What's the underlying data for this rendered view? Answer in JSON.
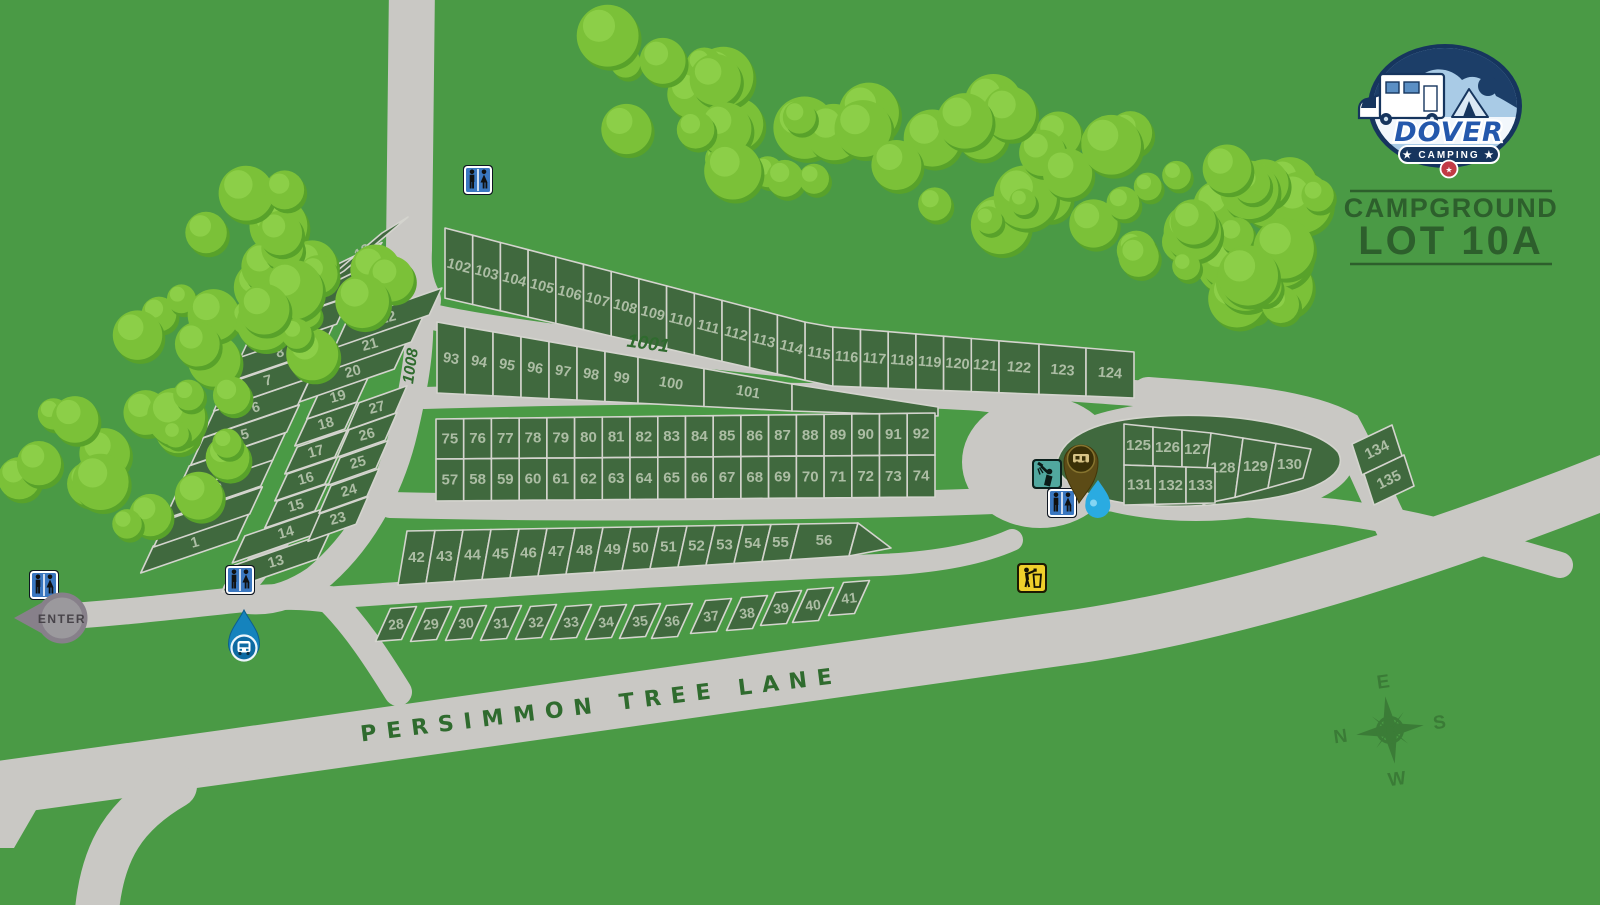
{
  "brand": {
    "logo_text": "DOVER",
    "logo_subtitle": "★ CAMPING ★",
    "title_line1": "CAMPGROUND",
    "title_line2": "LOT 10A"
  },
  "road_labels": {
    "main_road": "PERSIMMON TREE LANE",
    "loop_road": "1001",
    "spur_road": "1008"
  },
  "entrance": {
    "label": "ENTER"
  },
  "compass": {
    "north": "N",
    "east": "E",
    "south": "S",
    "west": "W"
  },
  "site_rows": {
    "west_outer": [
      1,
      2,
      3,
      4,
      5,
      6,
      7,
      8,
      9,
      10,
      11,
      12
    ],
    "west_inner": [
      13,
      14,
      15,
      16,
      17,
      18,
      19,
      20,
      21,
      22
    ],
    "west_court": [
      23,
      24,
      25,
      26,
      27
    ],
    "row_28_41": [
      28,
      29,
      30,
      31,
      32,
      33,
      34,
      35,
      36,
      37,
      38,
      39,
      40,
      41
    ],
    "row_42_56": [
      42,
      43,
      44,
      45,
      46,
      47,
      48,
      49,
      50,
      51,
      52,
      53,
      54,
      55,
      56
    ],
    "row_57_74": [
      57,
      58,
      59,
      60,
      61,
      62,
      63,
      64,
      65,
      66,
      67,
      68,
      69,
      70,
      71,
      72,
      73,
      74
    ],
    "row_75_92": [
      75,
      76,
      77,
      78,
      79,
      80,
      81,
      82,
      83,
      84,
      85,
      86,
      87,
      88,
      89,
      90,
      91,
      92
    ],
    "row_93_101": [
      93,
      94,
      95,
      96,
      97,
      98,
      99,
      100,
      101
    ],
    "row_102_124": [
      102,
      103,
      104,
      105,
      106,
      107,
      108,
      109,
      110,
      111,
      112,
      113,
      114,
      115,
      116,
      117,
      118,
      119,
      120,
      121,
      122,
      123,
      124
    ],
    "island_upper": [
      125,
      126,
      127,
      128,
      129,
      130
    ],
    "island_lower": [
      131,
      132,
      133
    ],
    "east_pair": [
      134,
      135
    ]
  },
  "facilities": [
    {
      "id": "restroom-north",
      "type": "restroom-icon"
    },
    {
      "id": "restroom-west",
      "type": "restroom-icon"
    },
    {
      "id": "restroom-central",
      "type": "restroom-icon"
    },
    {
      "id": "shower-station",
      "type": "shower-icon"
    },
    {
      "id": "restroom-east",
      "type": "restroom-icon"
    },
    {
      "id": "rv-service-pin",
      "type": "rv-pin-icon"
    },
    {
      "id": "water-point",
      "type": "water-drop-icon"
    },
    {
      "id": "trash-station",
      "type": "trash-icon"
    },
    {
      "id": "rv-water-fill",
      "type": "water-fill-icon"
    }
  ],
  "palette": {
    "grass": "#4a9a45",
    "road": "#c9c8c4",
    "site_fill": "#40693e",
    "site_border": "#d4d4ce",
    "site_number": "#acbda4",
    "map_text_green": "#2f6b2e",
    "title_green": "#2d5f2c",
    "tree_base": "#7bc138",
    "tree_shadow": "#58a22a",
    "tree_light": "#8ed04a",
    "restroom_blue": "#3a77c0",
    "shower_teal": "#51a89f",
    "trash_yellow": "#efd02b",
    "pin_brown": "#5c4b16",
    "pin_inner": "#3a3007",
    "water_blue": "#2aabe1",
    "enter_gray": "#9b999d",
    "enter_ring": "#87808a",
    "logo_navy": "#16355e",
    "logo_sky": "#a9cbe6",
    "logo_blue": "#2458ac",
    "logo_red": "#c23a45"
  }
}
